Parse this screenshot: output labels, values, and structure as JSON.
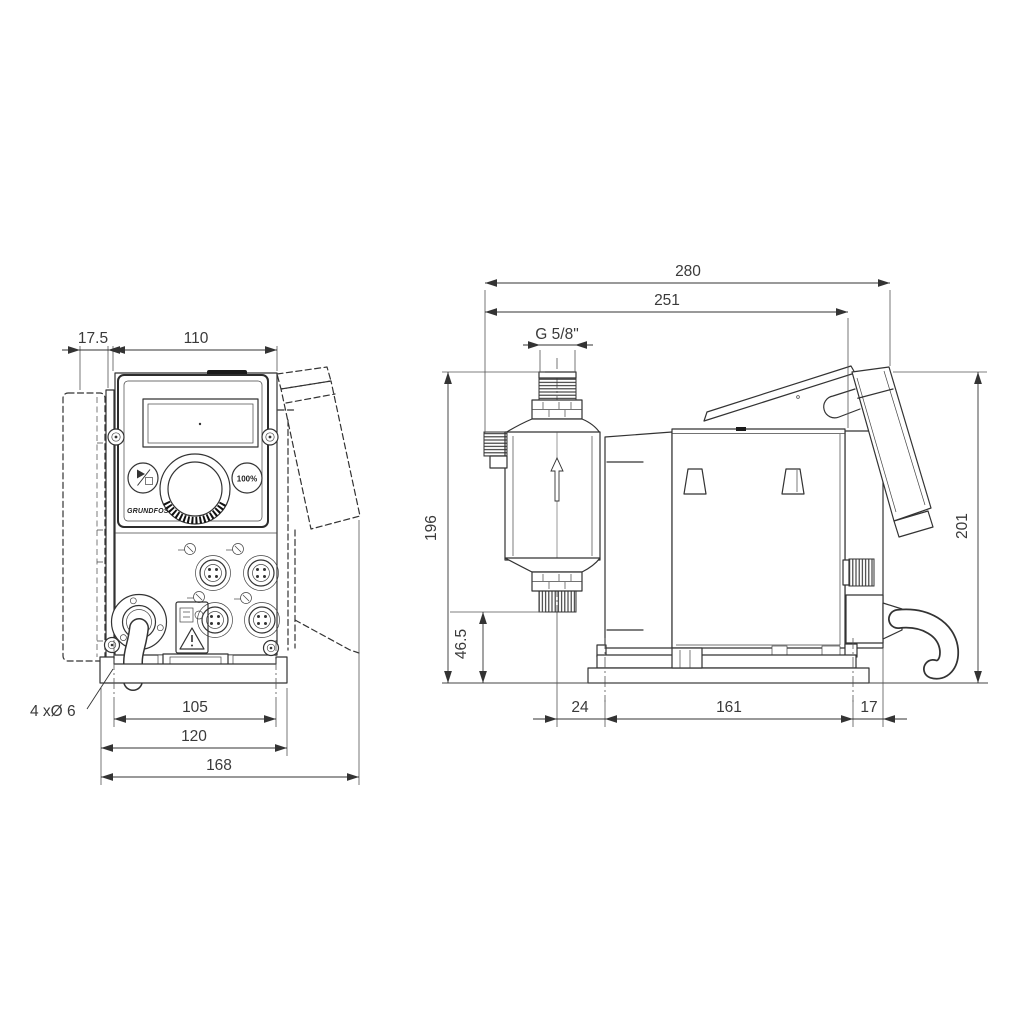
{
  "drawing_type": "pump dimensional drawing",
  "front_view": {
    "dimensions": {
      "bracket_offset": "17.5",
      "housing_width": "110",
      "mounting_hole_spacing": "105",
      "base_plate_width": "120",
      "overall_width": "168",
      "mounting_holes_note": "4 xØ 6"
    },
    "control_panel": {
      "capacity_button": "100%",
      "brand_logo": "GRUNDFOS"
    }
  },
  "side_view": {
    "dimensions": {
      "overall_depth": "280",
      "depth_to_housing_rear": "251",
      "connection_thread": "G 5/8\"",
      "height_to_connection_top": "196",
      "valve_bottom_height": "46.5",
      "head_center_to_front_hole": "24",
      "mounting_hole_spacing": "161",
      "rear_hole_to_housing_rear": "17",
      "overall_height": "201"
    }
  },
  "colors": {
    "line": "#333333",
    "text": "#3a3a3a",
    "background": "#ffffff"
  }
}
